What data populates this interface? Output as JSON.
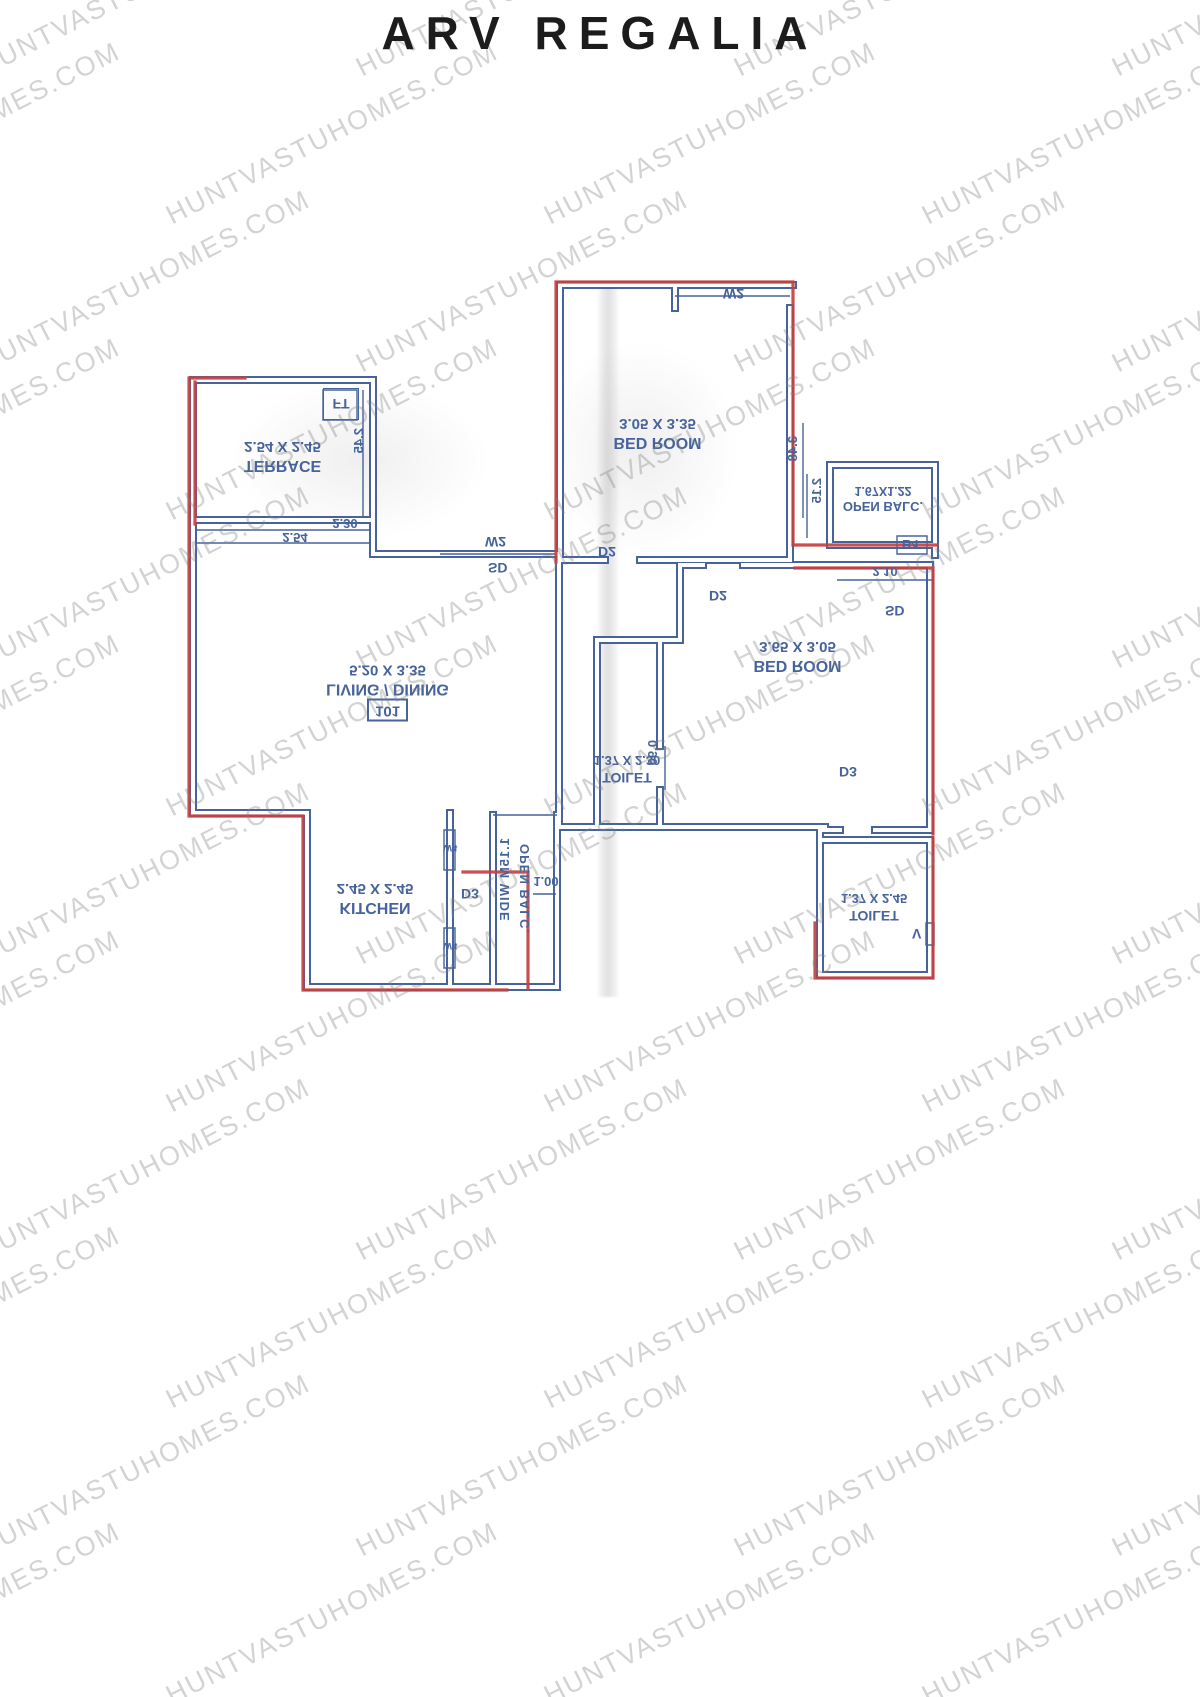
{
  "title": "ARV REGALIA",
  "watermark": "HUNTVASTUHOMES.COM",
  "colors": {
    "wall": "#46639b",
    "overlay": "#c64040",
    "label_text": "#46639b",
    "title_text": "#1c1c1c",
    "watermark_text": "#bdbdbd"
  },
  "plan": {
    "note": "floor plan is scanned vertically mirrored (all text appears flipped)",
    "unit_number": "101",
    "rooms": {
      "terrace": {
        "name": "TERRACE",
        "dims": "2.54 X 2.45"
      },
      "bedroom_top": {
        "name": "BED ROOM",
        "dims": "3.05 X 3.35"
      },
      "open_balc_top": {
        "name": "OPEN BALC.",
        "dims": "1.67X1.22"
      },
      "living_dining": {
        "name": "LIVING / DINING",
        "dims": "5.20 X 3.35"
      },
      "toilet_mid": {
        "name": "TOILET",
        "dims": "1.37 X 2.30"
      },
      "bedroom_right": {
        "name": "BED ROOM",
        "dims": "3.65 X 3.05"
      },
      "toilet_right": {
        "name": "TOILET",
        "dims": "1.37 X 2.45"
      },
      "kitchen": {
        "name": "KITCHEN",
        "dims": "2.45 X 2.45"
      },
      "open_balc_bottom": {
        "name": "OPEN BALC.",
        "width_note": "1.15M WIDE"
      }
    },
    "markers": {
      "ft": "FT",
      "w2_top": "W2",
      "w2_left": "W2",
      "sd_left": "SD",
      "sd_right": "SD",
      "d2_a": "D2",
      "d2_b": "D2",
      "d3_kitchen": "D3",
      "d3_bedroom": "D3",
      "w4_a": "W4",
      "w4_b": "W4",
      "b4": "B4",
      "vent": "V"
    },
    "dimensions": {
      "terrace_w": "2.30",
      "terrace_w_outer": "2.54",
      "terrace_h": "2.45",
      "bed_side": "3.48",
      "balc_h": "2.15",
      "balc_w": "2.10",
      "toilet_door": "0.90",
      "balc_bottom_w": "1.00"
    }
  }
}
